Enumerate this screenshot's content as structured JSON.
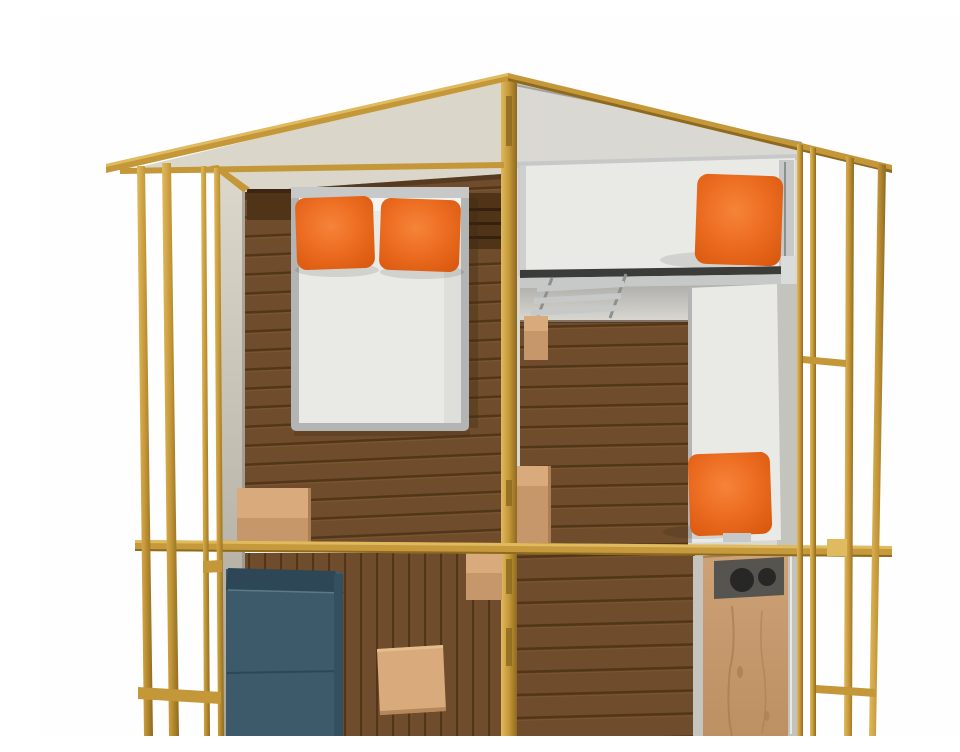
{
  "meta": {
    "caption": "Cutaway 3D illustration of a timber-framed lodge tent: left bedroom with double bed and two orange pillows, right bedroom with raised bunk bed, ladder and bench bed with orange cushions, living area with dark teal sofa and pine side table, and a kitchenette cabinet with twin sink holes, all inside a golden wooden post-and-beam frame with a gabled roof."
  },
  "scene": {
    "rooms": [
      {
        "name": "bedroom-double",
        "furniture": [
          "double-bed",
          "orange-pillows",
          "headboard-shelf",
          "storage-bench"
        ]
      },
      {
        "name": "bedroom-bunks",
        "furniture": [
          "bunk-bed",
          "bunk-ladder",
          "bench-bed",
          "orange-cushions",
          "step-box"
        ]
      },
      {
        "name": "living-area",
        "furniture": [
          "teal-sofa",
          "pine-table",
          "storage-box"
        ]
      },
      {
        "name": "kitchenette",
        "furniture": [
          "kitchen-cabinet",
          "sink-holes"
        ]
      }
    ],
    "colors": {
      "white_bg": "#FEFEFE",
      "wall_beige": "#DBD6CA",
      "wall_beige_dark": "#A9A499",
      "wall_grey": "#D9D8D3",
      "roof_under_grey": "#CECDC8",
      "wall_grey_dark": "#C4C3BE",
      "wall_edge_dark": "#A3A19B",
      "frame_gold": "#C49738",
      "frame_gold_light": "#E0BA5E",
      "frame_gold_dark": "#8E6A20",
      "beam_gold": "#C69A3C",
      "floor_dark": "#6F4C2B",
      "floor_line": "#523619",
      "floor_light_plank": "#8A6138",
      "mattress_white": "#E9E9E6",
      "mattress_frame_grey": "#B3B5B4",
      "sheet_white": "#F4F4F1",
      "silver": "#C7C9C9",
      "silver_light": "#DADCDC",
      "silver_dark": "#8E9090",
      "bunk_front_dark": "#3B3B39",
      "underbunk_top": "#AFAEAA",
      "headboard_brown": "#4F3418",
      "headboard_line": "#35200E",
      "pine_light": "#D8AA7C",
      "pine_mid": "#C6976A",
      "pine_dark": "#AC7F53",
      "pine_front_top": "#CDA276",
      "pine_front_bottom": "#BD9063",
      "sofa_teal": "#3C5A69",
      "sofa_teal_dark": "#2E4756",
      "sofa_teal_light": "#5A7A8A",
      "counter_grey": "#55544E",
      "hole_black": "#272725",
      "pillow_orange": "#EE6F23",
      "pillow_orange_dark": "#D8590F",
      "pillow_orange_light": "#F5843A",
      "grain": "#A87C50",
      "cabinet_sliver": "#C6C4BF",
      "cabinet_strip": "#C2C2BE"
    }
  }
}
